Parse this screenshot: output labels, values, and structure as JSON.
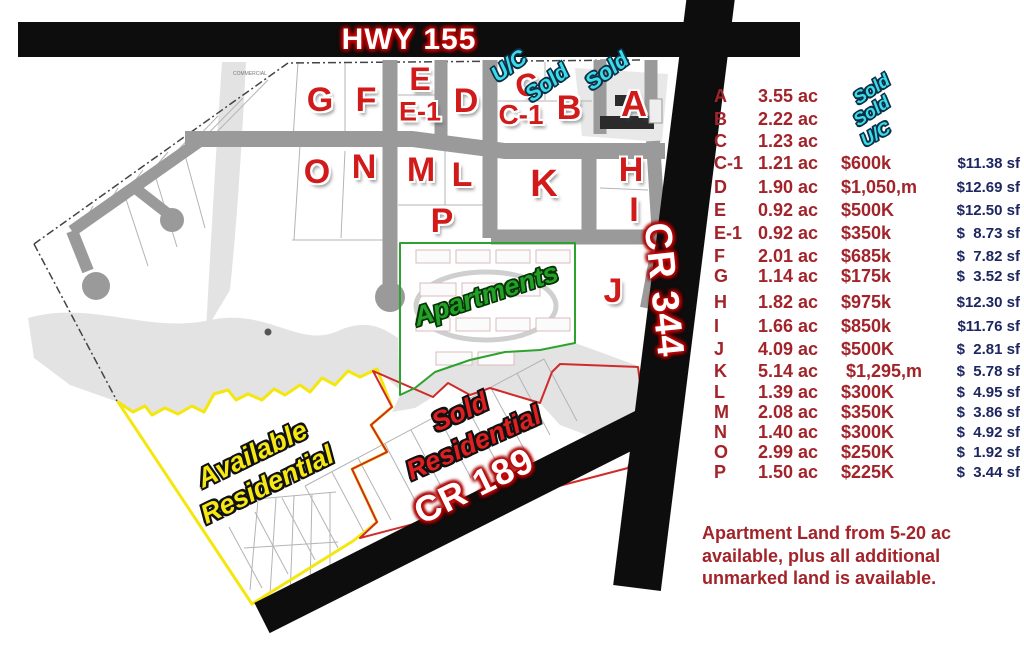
{
  "roads": {
    "hwy155": "HWY 155",
    "cr344": "CR 344",
    "cr189": "CR 189"
  },
  "map": {
    "commercial_note": "COMMERCIAL",
    "area_labels": {
      "apartments": "Apartments",
      "available_line1": "Available",
      "available_line2": "Residential",
      "sold_line1": "Sold",
      "sold_line2": "Residential"
    },
    "lot_markers": [
      {
        "label": "G",
        "x": 320,
        "y": 100,
        "size": 34
      },
      {
        "label": "F",
        "x": 366,
        "y": 100,
        "size": 34
      },
      {
        "label": "E",
        "x": 420,
        "y": 79,
        "size": 32
      },
      {
        "label": "E-1",
        "x": 420,
        "y": 112,
        "size": 27
      },
      {
        "label": "D",
        "x": 466,
        "y": 101,
        "size": 34
      },
      {
        "label": "C",
        "x": 527,
        "y": 85,
        "size": 32,
        "rotate": -14
      },
      {
        "label": "C-1",
        "x": 521,
        "y": 115,
        "size": 28
      },
      {
        "label": "B",
        "x": 569,
        "y": 108,
        "size": 34
      },
      {
        "label": "A",
        "x": 634,
        "y": 104,
        "size": 36
      },
      {
        "label": "O",
        "x": 317,
        "y": 172,
        "size": 34
      },
      {
        "label": "N",
        "x": 364,
        "y": 167,
        "size": 34
      },
      {
        "label": "M",
        "x": 421,
        "y": 170,
        "size": 34
      },
      {
        "label": "L",
        "x": 462,
        "y": 175,
        "size": 34
      },
      {
        "label": "P",
        "x": 442,
        "y": 221,
        "size": 34
      },
      {
        "label": "K",
        "x": 544,
        "y": 184,
        "size": 38
      },
      {
        "label": "H",
        "x": 631,
        "y": 170,
        "size": 34
      },
      {
        "label": "I",
        "x": 634,
        "y": 210,
        "size": 34
      },
      {
        "label": "J",
        "x": 613,
        "y": 291,
        "size": 34
      }
    ],
    "status_markers": [
      {
        "label": "U/C",
        "x": 509,
        "y": 66
      },
      {
        "label": "Sold",
        "x": 547,
        "y": 83
      },
      {
        "label": "Sold",
        "x": 607,
        "y": 71
      }
    ]
  },
  "price_table": {
    "rows": [
      {
        "lot": "A",
        "acres": "3.55 ac",
        "status": "Sold",
        "price": "",
        "sf": ""
      },
      {
        "lot": "B",
        "acres": "2.22 ac",
        "status": "Sold",
        "price": "",
        "sf": ""
      },
      {
        "lot": "C",
        "acres": "1.23 ac",
        "status": "U/C",
        "price": "",
        "sf": ""
      },
      {
        "lot": "C-1",
        "acres": "1.21 ac",
        "status": "",
        "price": "$600k",
        "sf": "$11.38 sf"
      },
      {
        "lot": "D",
        "acres": "1.90 ac",
        "status": "",
        "price": "$1,050,m",
        "sf": "$12.69 sf"
      },
      {
        "lot": "E",
        "acres": "0.92 ac",
        "status": "",
        "price": "$500K",
        "sf": "$12.50 sf"
      },
      {
        "lot": "E-1",
        "acres": "0.92 ac",
        "status": "",
        "price": "$350k",
        "sf": "$  8.73 sf"
      },
      {
        "lot": "F",
        "acres": "2.01 ac",
        "status": "",
        "price": "$685k",
        "sf": "$  7.82 sf"
      },
      {
        "lot": "G",
        "acres": "1.14 ac",
        "status": "",
        "price": "$175k",
        "sf": "$  3.52 sf"
      },
      {
        "lot": "H",
        "acres": "1.82 ac",
        "status": "",
        "price": "$975k",
        "sf": "$12.30 sf"
      },
      {
        "lot": "I",
        "acres": "1.66 ac",
        "status": "",
        "price": "$850k",
        "sf": "$11.76 sf"
      },
      {
        "lot": "J",
        "acres": "4.09 ac",
        "status": "",
        "price": "$500K",
        "sf": "$  2.81 sf"
      },
      {
        "lot": "K",
        "acres": "5.14 ac",
        "status": "",
        "price": " $1,295,m",
        "sf": "$  5.78 sf"
      },
      {
        "lot": "L",
        "acres": "1.39 ac",
        "status": "",
        "price": "$300K",
        "sf": "$  4.95 sf"
      },
      {
        "lot": "M",
        "acres": "2.08 ac",
        "status": "",
        "price": "$350K",
        "sf": "$  3.86 sf"
      },
      {
        "lot": "N",
        "acres": "1.40 ac",
        "status": "",
        "price": "$300K",
        "sf": "$  4.92 sf"
      },
      {
        "lot": "O",
        "acres": "2.99 ac",
        "status": "",
        "price": "$250K",
        "sf": "$  1.92 sf"
      },
      {
        "lot": "P",
        "acres": "1.50 ac",
        "status": "",
        "price": "$225K",
        "sf": "$  3.44 sf"
      }
    ]
  },
  "footer_note": {
    "line1": "Apartment Land from 5-20 ac",
    "line2": "available, plus all additional",
    "line3": "unmarked land is available."
  },
  "colors": {
    "lot_marker_red": "#d11a1a",
    "table_red": "#a2242a",
    "per_sf_navy": "#1d2660",
    "status_cyan": "#3bdce8",
    "apartments_green": "#23a127",
    "available_yellow": "#f6e813",
    "road_black": "#0d0d0d",
    "interior_road_gray": "#9a9a9a"
  }
}
